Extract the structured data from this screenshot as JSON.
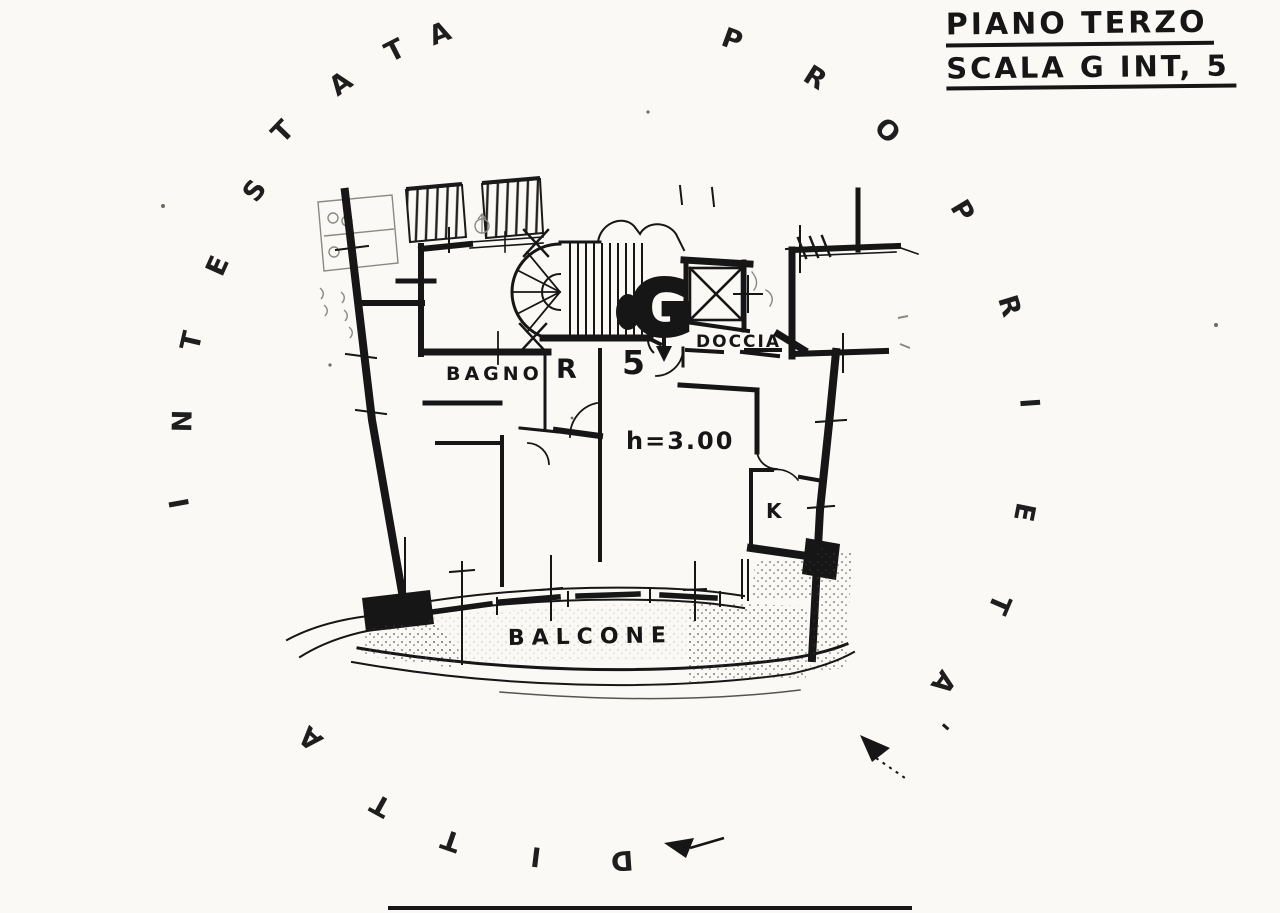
{
  "title": {
    "line1": "PIANO TERZO",
    "line2": "SCALA G INT, 5"
  },
  "plan_labels": {
    "bagno": "BAGNO",
    "ripostiglio": "R",
    "interno": "5",
    "doccia": "DOCCIA",
    "stair_letter": "G",
    "altezza": "h=3.00",
    "cucina": "K",
    "balcone": "BALCONE"
  },
  "watermark": {
    "text": "INTESTATA PROPRIETA' DITTA",
    "letters": [
      {
        "ch": "I",
        "x": 180,
        "y": 503,
        "rot": -100
      },
      {
        "ch": "N",
        "x": 183,
        "y": 421,
        "rot": -89
      },
      {
        "ch": "T",
        "x": 192,
        "y": 341,
        "rot": -77
      },
      {
        "ch": "E",
        "x": 218,
        "y": 266,
        "rot": -66
      },
      {
        "ch": "S",
        "x": 255,
        "y": 191,
        "rot": -54
      },
      {
        "ch": "T",
        "x": 283,
        "y": 132,
        "rot": -46
      },
      {
        "ch": "A",
        "x": 341,
        "y": 84,
        "rot": -36
      },
      {
        "ch": "T",
        "x": 395,
        "y": 51,
        "rot": -27
      },
      {
        "ch": "A",
        "x": 440,
        "y": 34,
        "rot": -21
      },
      {
        "ch": "P",
        "x": 732,
        "y": 40,
        "rot": 20
      },
      {
        "ch": "R",
        "x": 815,
        "y": 78,
        "rot": 32
      },
      {
        "ch": "O",
        "x": 887,
        "y": 131,
        "rot": 45
      },
      {
        "ch": "P",
        "x": 962,
        "y": 211,
        "rot": 59
      },
      {
        "ch": "R",
        "x": 1009,
        "y": 306,
        "rot": 73
      },
      {
        "ch": "I",
        "x": 1029,
        "y": 403,
        "rot": 86
      },
      {
        "ch": "E",
        "x": 1024,
        "y": 512,
        "rot": 101
      },
      {
        "ch": "T",
        "x": 999,
        "y": 604,
        "rot": 113
      },
      {
        "ch": "A",
        "x": 943,
        "y": 682,
        "rot": 126
      },
      {
        "ch": "'",
        "x": 940,
        "y": 722,
        "rot": 131
      },
      {
        "ch": "D",
        "x": 622,
        "y": 860,
        "rot": 176
      },
      {
        "ch": "I",
        "x": 536,
        "y": 856,
        "rot": -173
      },
      {
        "ch": "T",
        "x": 451,
        "y": 840,
        "rot": -161
      },
      {
        "ch": "T",
        "x": 381,
        "y": 805,
        "rot": -151
      },
      {
        "ch": "A",
        "x": 311,
        "y": 738,
        "rot": -138
      }
    ]
  },
  "drawing": {
    "ink": "#1a1a1a",
    "paper": "#faf9f5"
  }
}
